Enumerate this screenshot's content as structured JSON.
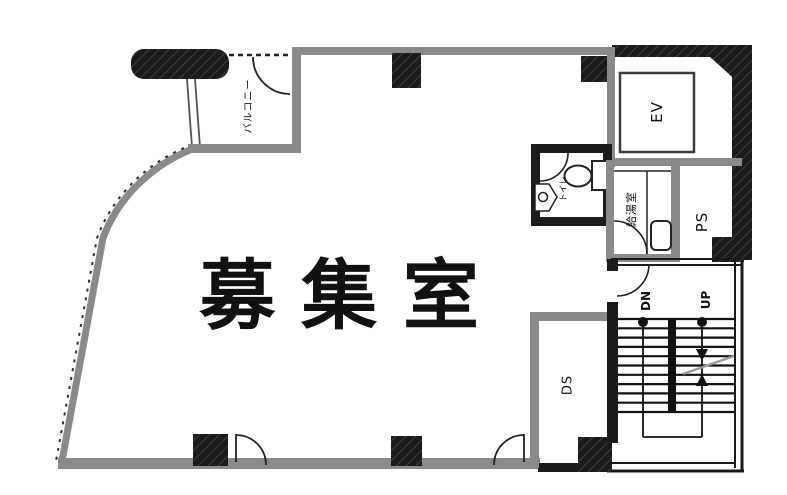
{
  "floor_plan": {
    "rooms": {
      "main_room": "募集室",
      "balcony": "バルコニー",
      "elevator": "EV",
      "pipe_shaft": "PS",
      "duct_shaft": "DS",
      "kitchenette": "給湯室",
      "toilet": "トイレ"
    },
    "stairs": {
      "down": "DN",
      "up": "UP"
    },
    "colors": {
      "wall_gray": "#8a8a8a",
      "wall_black": "#1b1b1b",
      "thin_line_black": "#1a1a1a",
      "break_line_gray": "#9a9a9a",
      "background": "#ffffff"
    }
  }
}
